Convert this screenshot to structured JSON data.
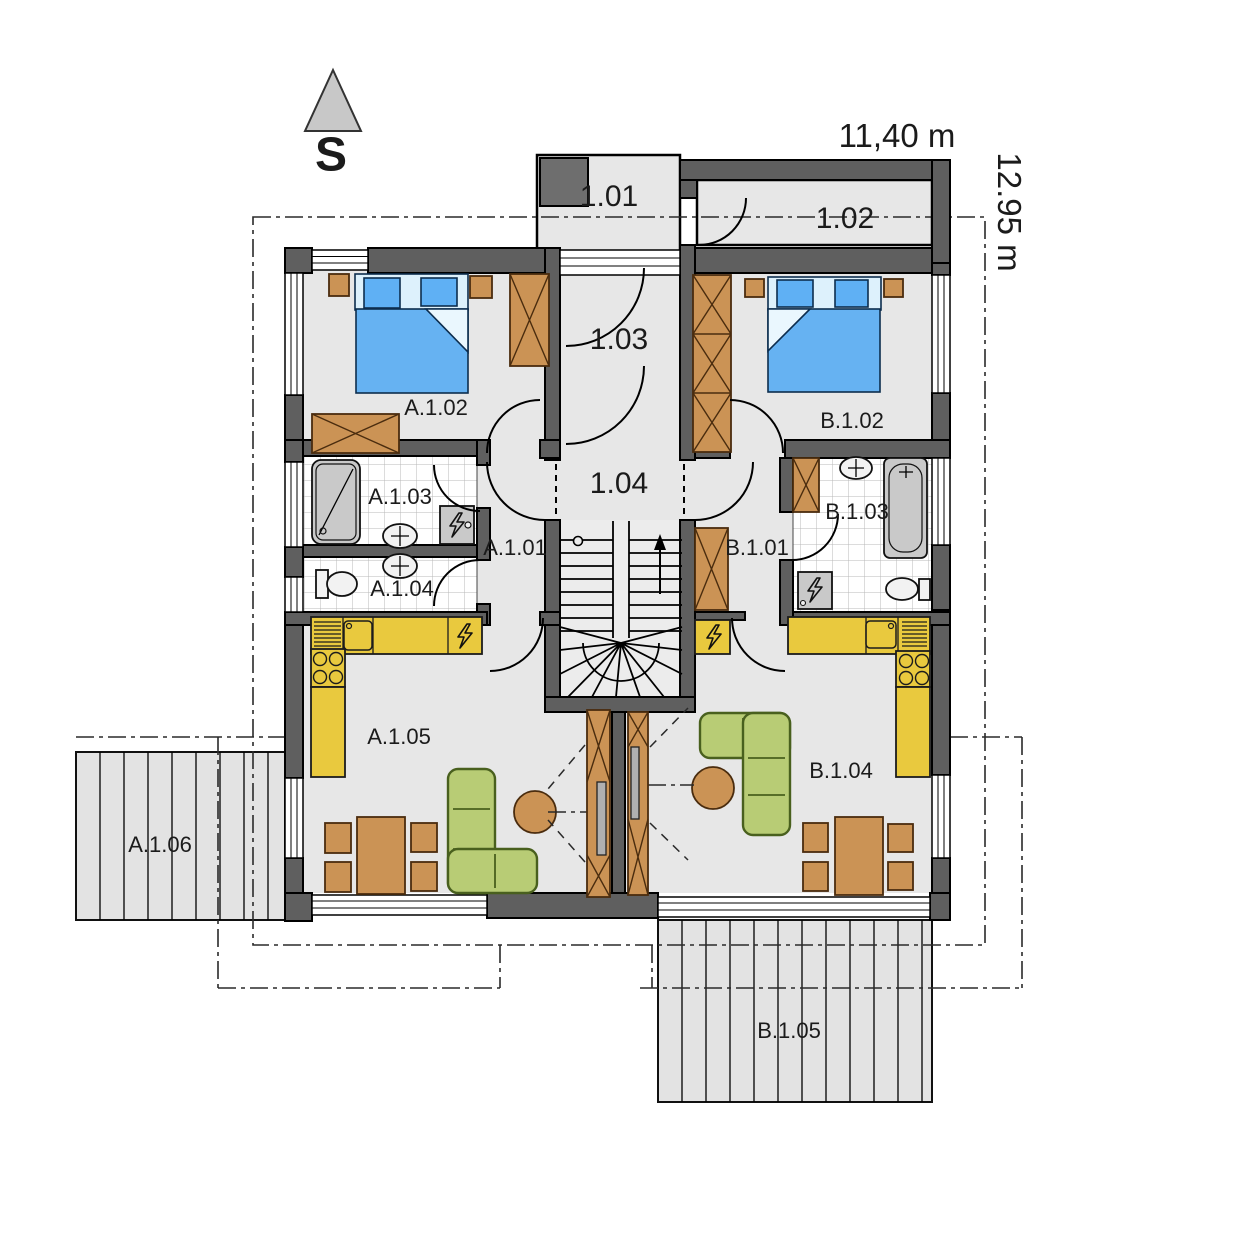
{
  "compass": {
    "label": "S"
  },
  "dimensions": {
    "width_label": "11,40 m",
    "height_label": "12.95 m"
  },
  "rooms": {
    "r101": "1.01",
    "r102": "1.02",
    "r103": "1.03",
    "r104": "1.04",
    "a101": "A.1.01",
    "a102": "A.1.02",
    "a103": "A.1.03",
    "a104": "A.1.04",
    "a105": "A.1.05",
    "a106": "A.1.06",
    "b101": "B.1.01",
    "b102": "B.1.02",
    "b103": "B.1.03",
    "b104": "B.1.04",
    "b105": "B.1.05"
  },
  "colors": {
    "wall": "#5f5f5f",
    "floor": "#e7e7e7",
    "tile_line": "#b9b9b9",
    "furniture_wood": "#cb9355",
    "kitchen": "#e9c93e",
    "bed": "#66b2f2",
    "bed_head": "#ddf1fc",
    "sofa": "#b8cc75",
    "terrace": "#e3e3e3",
    "fixture": "#c9c9c9"
  }
}
